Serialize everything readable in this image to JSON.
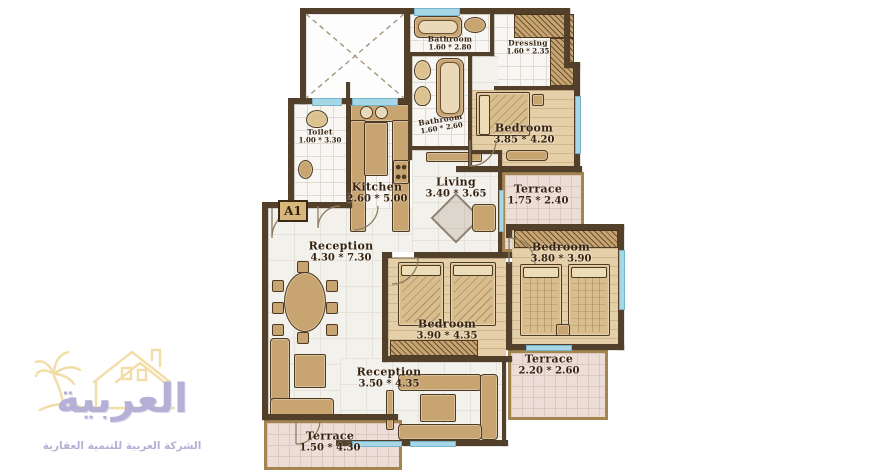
{
  "plan": {
    "unit_label": "A1",
    "rooms": {
      "bathroom_top": {
        "name": "Bathroom",
        "dims": "1.60 * 2.80"
      },
      "dressing": {
        "name": "Dressing",
        "dims": "1.60 * 2.35"
      },
      "toilet": {
        "name": "Toilet",
        "dims": "1.00 * 3.30"
      },
      "bathroom_mid": {
        "name": "Bathroom",
        "dims": "1.60 * 2.60"
      },
      "bedroom_top": {
        "name": "Bedroom",
        "dims": "3.85 * 4.20"
      },
      "kitchen": {
        "name": "Kitchen",
        "dims": "2.60 * 5.00"
      },
      "living": {
        "name": "Living",
        "dims": "3.40 * 3.65"
      },
      "terrace_top": {
        "name": "Terrace",
        "dims": "1.75 * 2.40"
      },
      "reception_main": {
        "name": "Reception",
        "dims": "4.30 * 7.30"
      },
      "bedroom_right": {
        "name": "Bedroom",
        "dims": "3.80 * 3.90"
      },
      "bedroom_mid": {
        "name": "Bedroom",
        "dims": "3.90 * 4.35"
      },
      "terrace_right": {
        "name": "Terrace",
        "dims": "2.20 * 2.60"
      },
      "reception_lower": {
        "name": "Reception",
        "dims": "3.50 * 4.35"
      },
      "terrace_bottom": {
        "name": "Terrace",
        "dims": "1.50 * 4.30"
      }
    }
  },
  "logo": {
    "brand": "العربية",
    "tagline": "الشركة العربية للتنمية العقارية"
  },
  "colors": {
    "wall": "#52402b",
    "furniture": "#c8a470",
    "wood_floor": "#e4cfa9",
    "tile_floor": "#f7f6f2",
    "marble_floor": "#f3f1ec",
    "terrace_floor": "#ecddd6",
    "window": "#a6d7e7",
    "label_text": "#35220f",
    "logo_gold": "#f2dda6",
    "logo_lavender": "#b5b0d5"
  }
}
